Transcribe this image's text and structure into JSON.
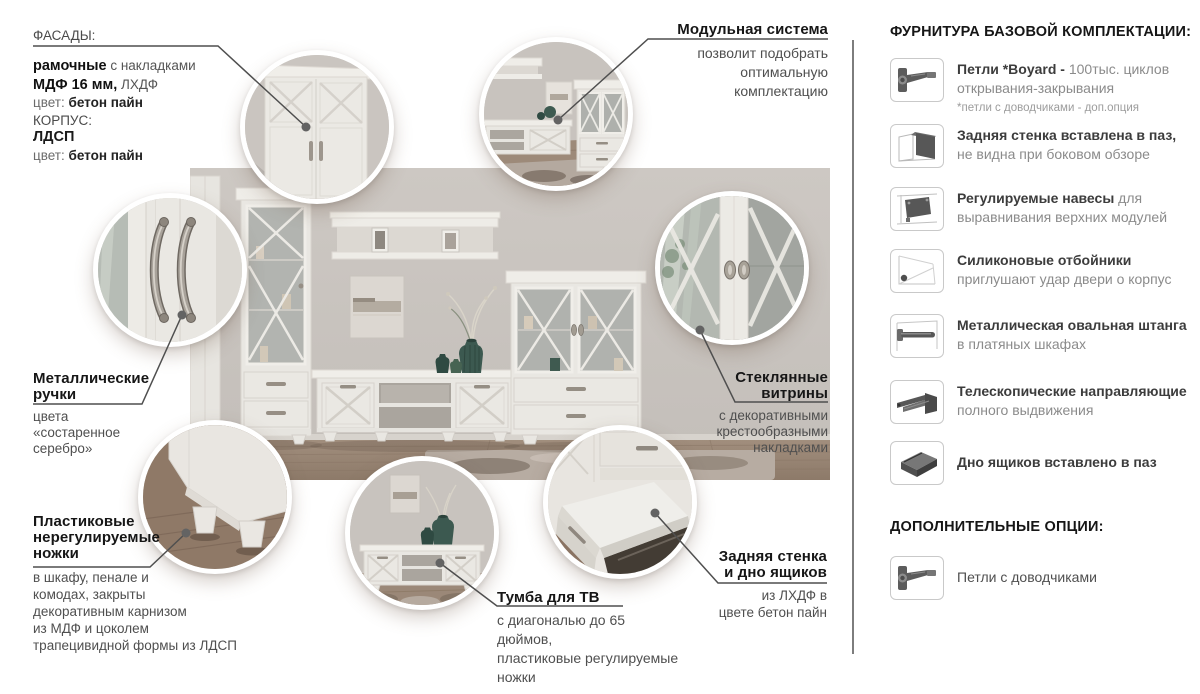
{
  "palette": {
    "wall": "#c8c3be",
    "floor": "#9c8878",
    "furniture": "#eae8e3",
    "glass": "#aeb1ac",
    "vase_green": "#3d5a50",
    "silver_handle": "#a29c93",
    "title_text": "#161616",
    "body_text": "#4f4f4f",
    "muted_text": "#8b8b8b",
    "connector_line": "#4f4f4f",
    "divider": "#7d7d7d",
    "icon_gray": "#575757"
  },
  "callouts": {
    "facades": {
      "title": "ФАСАДЫ:",
      "line1_bold": "рамочные",
      "line1_rest": " с накладками",
      "line2_bold": "МДФ 16 мм,",
      "line2_rest": " ЛХДФ",
      "line3_muted": "цвет: ",
      "line3_value": "бетон пайн",
      "line4": "КОРПУС:",
      "line5": "ЛДСП",
      "line6_muted": "цвет: ",
      "line6_value": "бетон пайн"
    },
    "modular": {
      "title": "Модульная система",
      "body_lines": [
        "позволит подобрать",
        "оптимальную",
        "комплектацию"
      ]
    },
    "handles": {
      "title_lines": [
        "Металлические",
        "ручки"
      ],
      "body_lines": [
        "цвета",
        "«состаренное",
        "серебро»"
      ]
    },
    "vitrines": {
      "title_lines": [
        "Стеклянные",
        "витрины"
      ],
      "body_lines": [
        "с декоративными",
        "крестообразными",
        "накладками"
      ]
    },
    "feet": {
      "title_lines": [
        "Пластиковые",
        "нерегулируемые",
        "ножки"
      ],
      "body_lines": [
        "в шкафу, пенале и",
        "комодах, закрыты",
        "декоративным карнизом",
        "из МДФ и цоколем",
        "трапецивидной формы из ЛДСП"
      ]
    },
    "tv": {
      "title": "Тумба для ТВ",
      "body_lines": [
        "с диагональю до 65 дюймов,",
        "пластиковые регулируемые",
        "ножки"
      ]
    },
    "back": {
      "title_lines": [
        "Задняя стенка",
        "и дно ящиков"
      ],
      "body_lines": [
        "из ЛХДФ в",
        "цвете бетон пайн"
      ]
    }
  },
  "sidebar": {
    "title": "ФУРНИТУРА БАЗОВОЙ КОМПЛЕКТАЦИИ:",
    "items": [
      {
        "icon": "hinge-icon",
        "bold": "Петли *Boyard - ",
        "rest": "100тыс. циклов открывания-закрывания",
        "note": "*петли с доводчиками - доп.опция"
      },
      {
        "icon": "back-panel-icon",
        "bold": "Задняя стенка вставлена в паз,",
        "rest": "не видна при боковом обзоре"
      },
      {
        "icon": "cabinet-hanger-icon",
        "bold": "Регулируемые навесы",
        "rest": " для выравнивания верхних модулей"
      },
      {
        "icon": "silicone-bumper-icon",
        "bold": "Силиконовые отбойники",
        "rest": "приглушают удар двери о корпус"
      },
      {
        "icon": "wardrobe-rod-icon",
        "bold": "Металлическая овальная штанга",
        "rest": "в платяных шкафах"
      },
      {
        "icon": "telescopic-slides-icon",
        "bold": "Телескопические направляющие",
        "rest": "полного выдвижения"
      },
      {
        "icon": "drawer-bottom-icon",
        "bold": "Дно ящиков вставлено в паз",
        "rest": ""
      }
    ],
    "options_title": "ДОПОЛНИТЕЛЬНЫЕ ОПЦИИ:",
    "options": [
      {
        "icon": "hinge-icon",
        "label": "Петли с доводчиками"
      }
    ]
  }
}
